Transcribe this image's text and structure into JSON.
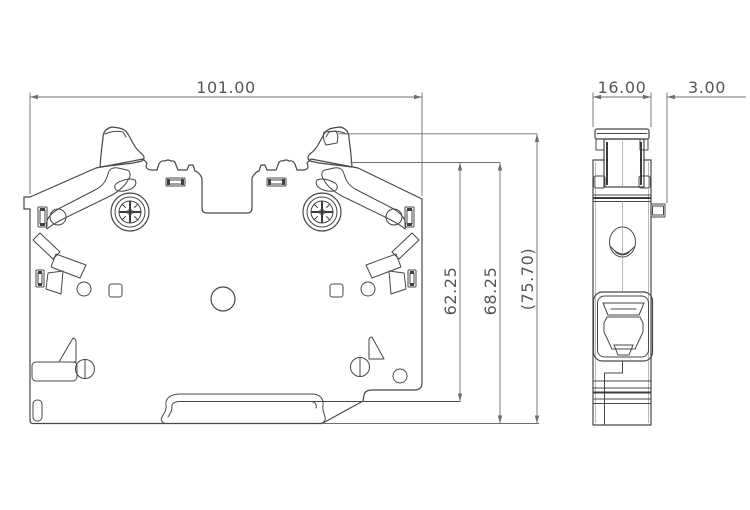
{
  "drawing": {
    "description": "DIN-rail fuse terminal block, front and side orthographic views",
    "dimensions": {
      "front_width": "101.00",
      "side_width": "16.00",
      "side_protrusion": "3.00",
      "height_inner": "62.25",
      "height_mid": "68.25",
      "height_overall": "(75.70)"
    },
    "colors": {
      "background": "#ffffff",
      "geometry_line": "#474747",
      "dimension_line": "#6f6f6f",
      "dimension_text": "#565656"
    }
  }
}
